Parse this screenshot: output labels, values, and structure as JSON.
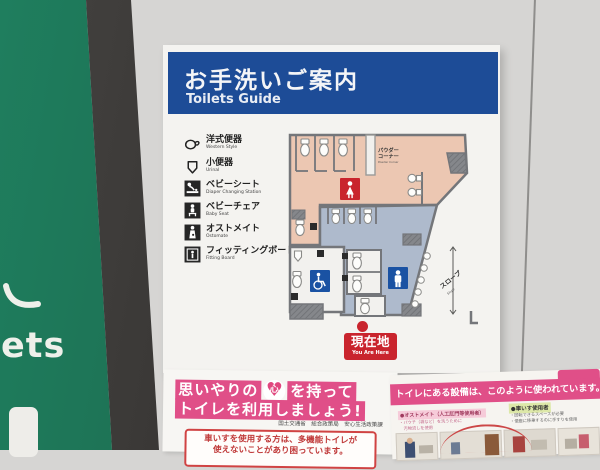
{
  "left_wall": {
    "partial_text": "ets"
  },
  "sign": {
    "header": {
      "title": "お手洗いご案内",
      "subtitle": "Toilets Guide"
    },
    "legend": [
      {
        "icon": "western-toilet-icon",
        "label": "洋式便器",
        "sub": "Western Style"
      },
      {
        "icon": "urinal-icon",
        "label": "小便器",
        "sub": "Urinal"
      },
      {
        "icon": "diaper-changing-icon",
        "label": "ベビーシート",
        "sub": "Diaper Changing Station"
      },
      {
        "icon": "baby-seat-icon",
        "label": "ベビーチェア",
        "sub": "Baby Seat"
      },
      {
        "icon": "ostomate-icon",
        "label": "オストメイト",
        "sub": "Ostomate"
      },
      {
        "icon": "fitting-board-icon",
        "label": "フィッティングボード",
        "sub": "Fitting Board"
      }
    ],
    "map": {
      "powder_corner_line1": "パウダー",
      "powder_corner_line2": "コーナー",
      "powder_corner_sub": "Powder Corner",
      "slope_label": "スロープ",
      "slope_sub": "Slope",
      "you_are_here": "現在地",
      "you_are_here_sub": "You Are Here"
    },
    "colors": {
      "header_blue": "#1d4c97",
      "womens_area_pink": "#ecc7b2",
      "mens_area_blue": "#aebacc",
      "womens_sign_red": "#c9242d",
      "mens_sign_blue": "#1a52a3",
      "accessible_sign_blue": "#1a52a3"
    }
  },
  "posters": {
    "left": {
      "line1_a": "思いやりの",
      "heart_char": "心",
      "line1_b": "を持って",
      "line2": "トイレを利用しましょう!",
      "credit": "国土交通省　総合政策局　安心生活政策課",
      "notice_line1": "車いすを使用する方は、多機能トイレが",
      "notice_line2": "使えないことがあり困っています。",
      "banner_pink": "#e04f88"
    },
    "right": {
      "banner": "トイレにある設備は、このように使われています。",
      "label_left_title": "●オストメイト（人工肛門等使用者）",
      "label_left_line1": "・パウチ（袋など）を洗うために",
      "label_left_line2": "　汚物流しを使用",
      "label_right_title": "●車いす使用者",
      "label_right_line1": "・回転できるスペースが必要",
      "label_right_line2": "・便座に移乗するのに手すりを使用"
    }
  }
}
